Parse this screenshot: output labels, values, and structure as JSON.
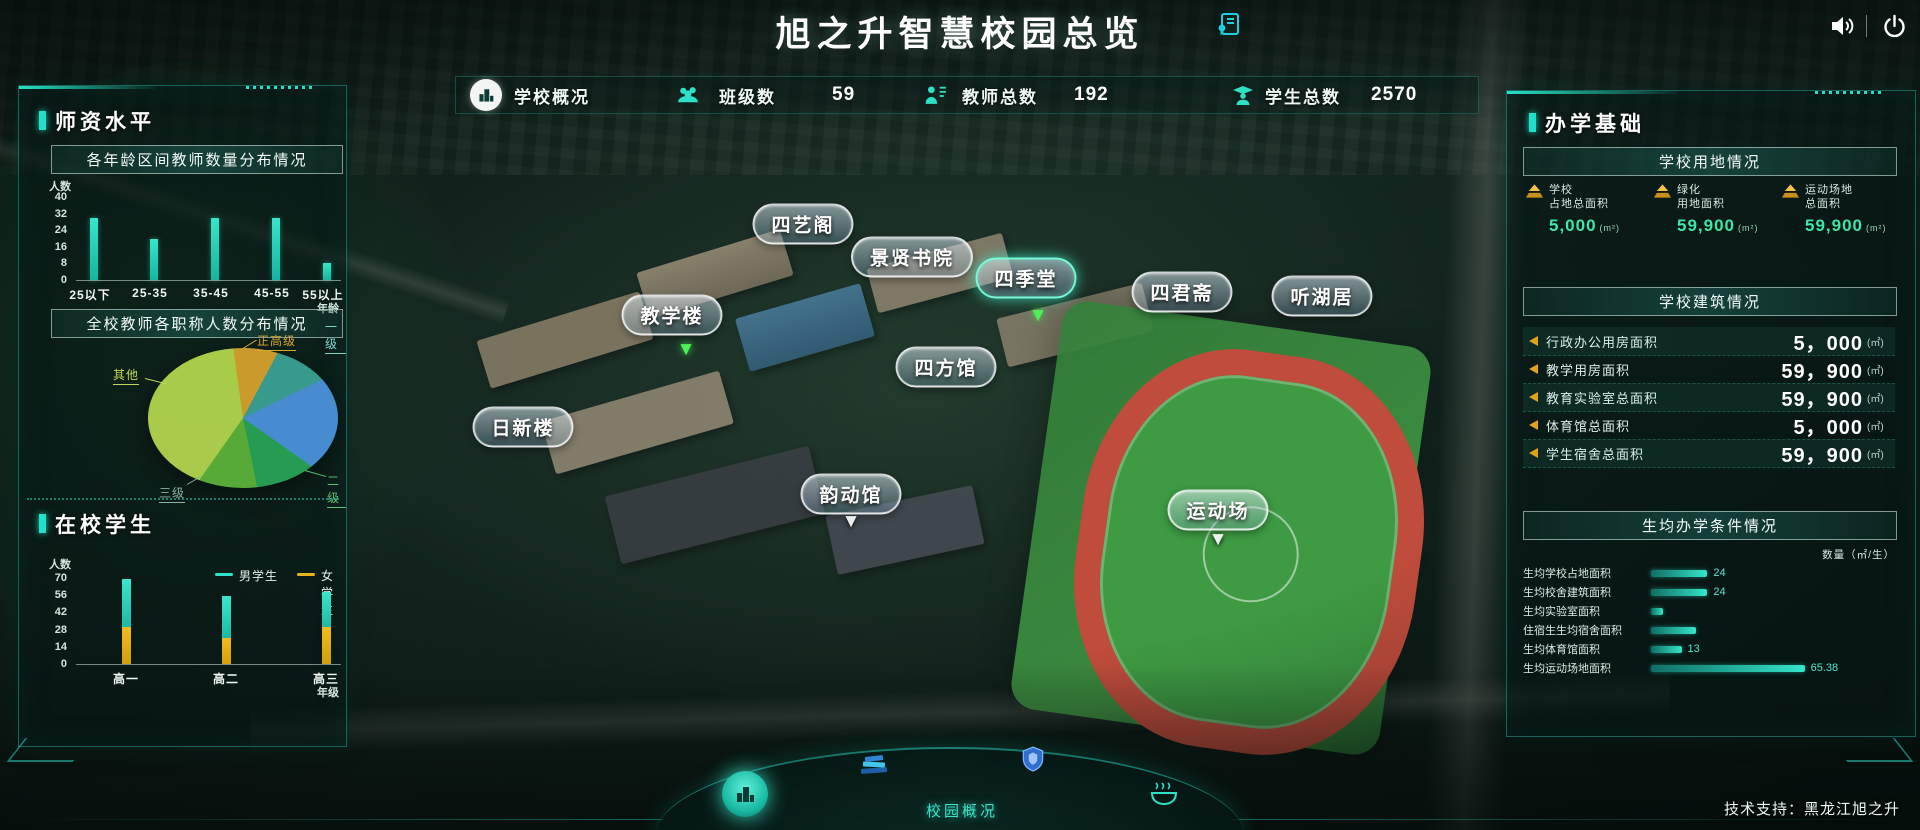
{
  "colors": {
    "accent": "#1fe0c8",
    "gold": "#d8a01d",
    "male_bar": "#2ee0c6",
    "female_bar": "#e8b417",
    "value_green": "#3fe6a6",
    "hbar": "#35e6c8"
  },
  "header": {
    "title": "旭之升智慧校园总览",
    "tech_support": "技术支持：黑龙江旭之升"
  },
  "stats_bar": {
    "school_label": "学校概况",
    "items": [
      {
        "label": "班级数",
        "value": "59"
      },
      {
        "label": "教师总数",
        "value": "192"
      },
      {
        "label": "学生总数",
        "value": "2570"
      }
    ]
  },
  "left_panel": {
    "section1_title": "师资水平",
    "section2_title": "在校学生"
  },
  "right_panel": {
    "title": "办学基础",
    "land": {
      "subtitle": "学校用地情况",
      "stats": [
        {
          "line1": "学校",
          "line2": "占地总面积",
          "value": "5,000",
          "unit": "(m²)"
        },
        {
          "line1": "绿化",
          "line2": "用地面积",
          "value": "59,900",
          "unit": "(m²)"
        },
        {
          "line1": "运动场地",
          "line2": "总面积",
          "value": "59,900",
          "unit": "(m²)"
        }
      ]
    },
    "building": {
      "subtitle": "学校建筑情况",
      "rows": [
        {
          "label": "行政办公用房面积",
          "value": "5，000",
          "unit": "(㎡)"
        },
        {
          "label": "教学用房面积",
          "value": "59，900",
          "unit": "(㎡)"
        },
        {
          "label": "教育实验室总面积",
          "value": "59，900",
          "unit": "(㎡)"
        },
        {
          "label": "体育馆总面积",
          "value": "5，000",
          "unit": "(㎡)"
        },
        {
          "label": "学生宿舍总面积",
          "value": "59，900",
          "unit": "(㎡)"
        }
      ]
    },
    "per_student": {
      "subtitle": "生均办学条件情况",
      "unit_label": "数量（㎡/生）"
    }
  },
  "map": {
    "arrow_glyph": "▼",
    "labels": [
      {
        "name": "四艺阁"
      },
      {
        "name": "景贤书院"
      },
      {
        "name": "四季堂"
      },
      {
        "name": "四君斋"
      },
      {
        "name": "听湖居"
      },
      {
        "name": "教学楼"
      },
      {
        "name": "四方馆"
      },
      {
        "name": "日新楼"
      },
      {
        "name": "韵动馆"
      },
      {
        "name": "运动场"
      }
    ]
  },
  "bottom_nav": {
    "active_label": "校园概况"
  },
  "chart_data": [
    {
      "type": "bar",
      "title": "各年龄区间教师数量分布情况",
      "ylabel": "人数",
      "xlabel": "年龄",
      "ylim": [
        0,
        40
      ],
      "yticks": [
        40,
        32,
        24,
        16,
        8,
        0
      ],
      "categories": [
        "25以下",
        "25-35",
        "35-45",
        "45-55",
        "55以上"
      ],
      "values": [
        30,
        20,
        30,
        30,
        8
      ],
      "bar_color": "#22d2ba"
    },
    {
      "type": "pie",
      "title": "全校教师各职称人数分布情况",
      "slices": [
        {
          "label": "正高级",
          "value": 10,
          "color": "#d2a02e"
        },
        {
          "label": "",
          "value": 10,
          "color": "#3a9e92"
        },
        {
          "label": "一级",
          "value": 17,
          "color": "#4a90d9"
        },
        {
          "label": "二级",
          "value": 12,
          "color": "#27a254"
        },
        {
          "label": "三级",
          "value": 13,
          "color": "#5cb03a"
        },
        {
          "label": "其他",
          "value": 38,
          "color": "#b0d24c"
        }
      ]
    },
    {
      "type": "stacked-bar",
      "title": "在校学生",
      "ylabel": "人数",
      "xlabel": "年级",
      "ylim": [
        0,
        70
      ],
      "yticks": [
        70,
        56,
        42,
        28,
        14,
        0
      ],
      "categories": [
        "高一",
        "高二",
        "高三"
      ],
      "series": [
        {
          "name": "男学生",
          "color": "#2ee0c6",
          "values": [
            39,
            34,
            29
          ]
        },
        {
          "name": "女学生",
          "color": "#e8b417",
          "values": [
            30,
            21,
            30
          ]
        }
      ]
    },
    {
      "type": "hbar",
      "title": "生均办学条件情况",
      "unit": "㎡/生",
      "categories": [
        "生均学校占地面积",
        "生均校舍建筑面积",
        "生均实验室面积",
        "住宿生生均宿舍面积",
        "生均体育馆面积",
        "生均运动场地面积"
      ],
      "values": [
        24,
        24,
        5,
        19,
        13,
        65.38
      ],
      "value_labels": [
        "24",
        "24",
        "",
        "",
        "13",
        "65.38"
      ]
    }
  ]
}
